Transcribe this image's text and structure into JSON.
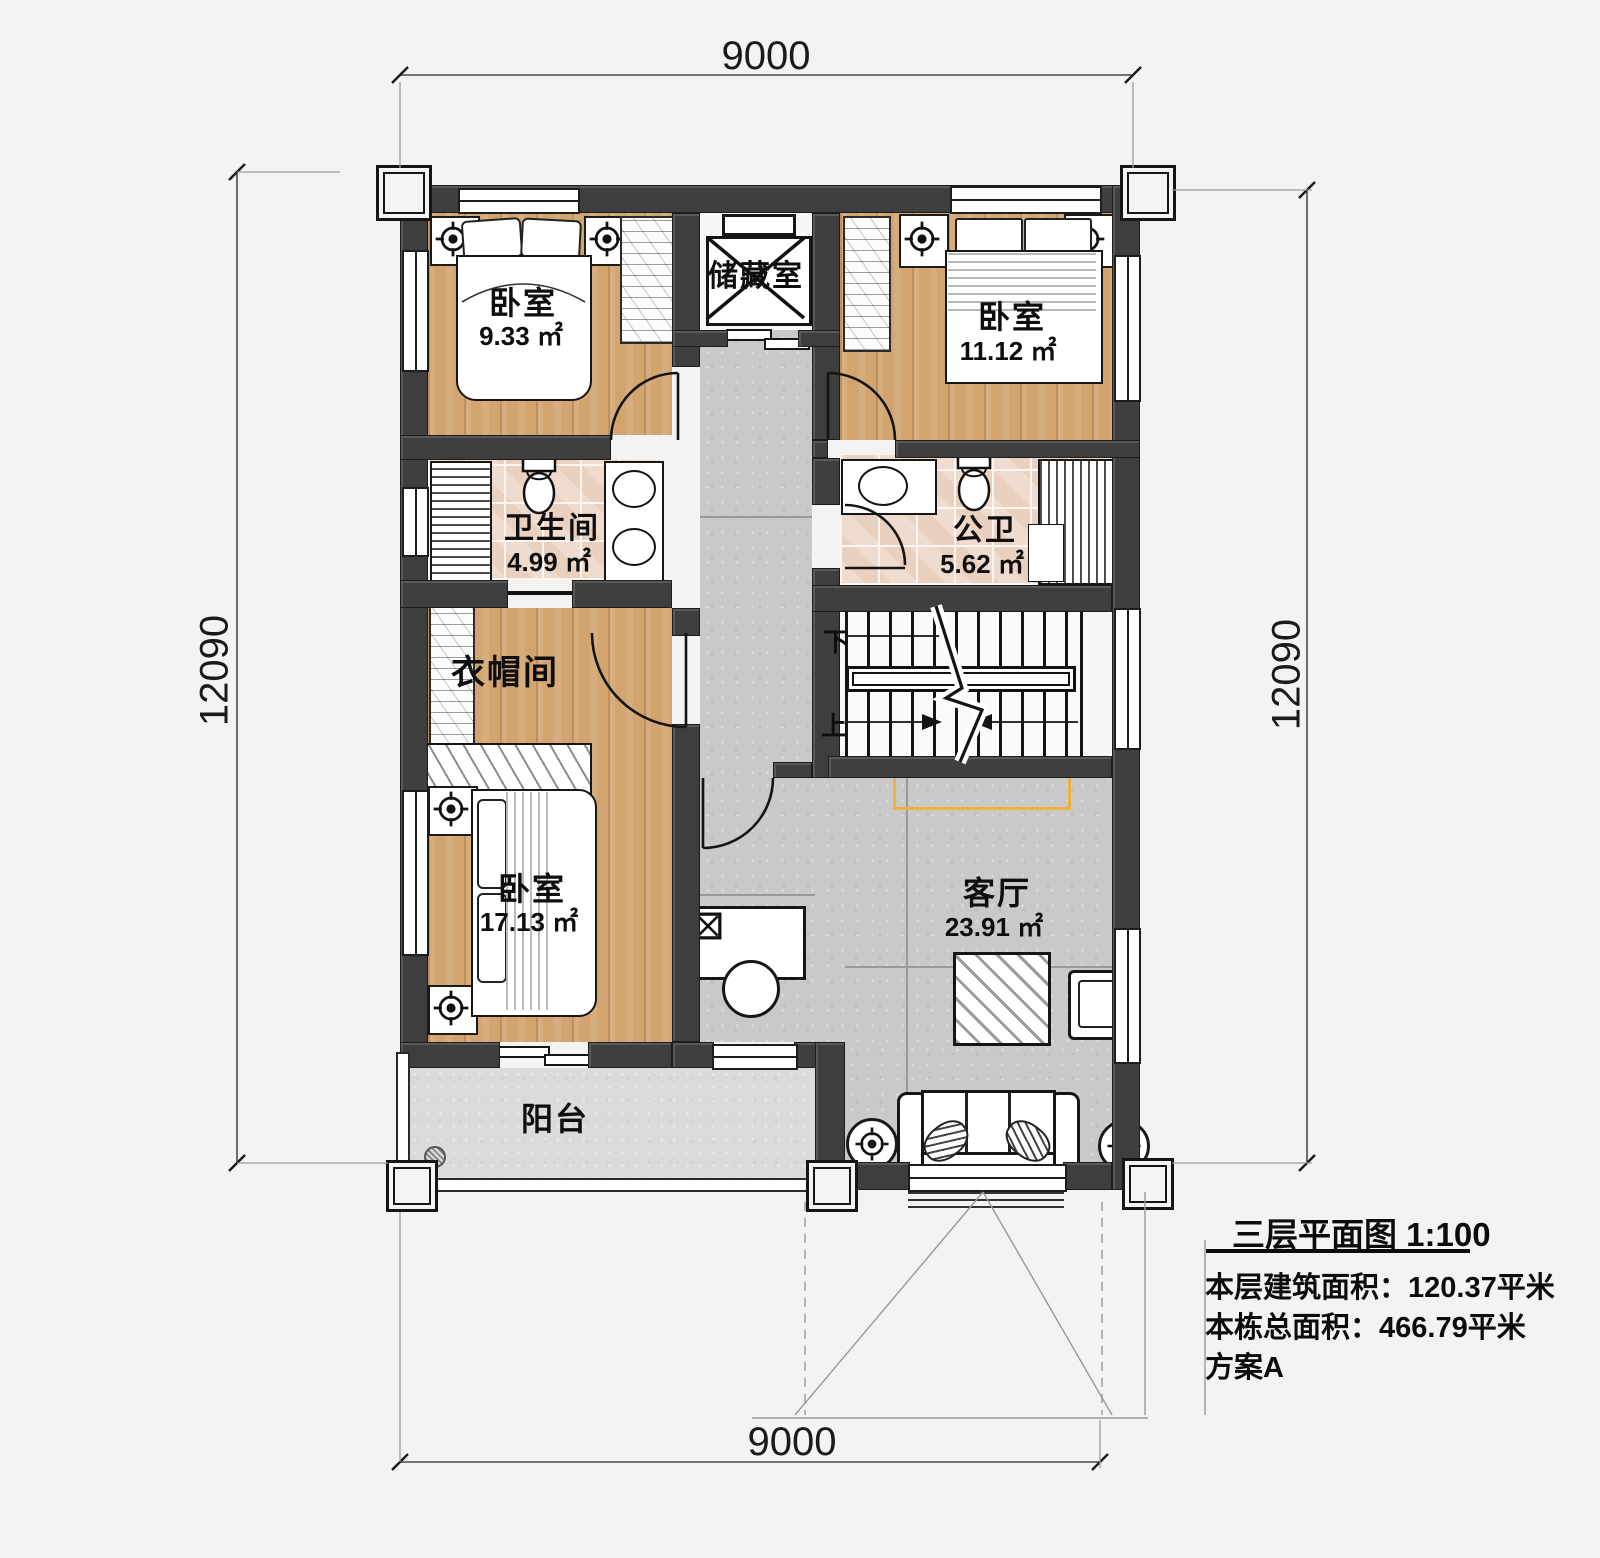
{
  "plan": {
    "dimensions": {
      "top": "9000",
      "bottom": "9000",
      "left": "12090",
      "right": "12090"
    },
    "rooms": {
      "bedroom_nw": {
        "label": "卧室",
        "area": "9.33 ㎡"
      },
      "storage": {
        "label": "储藏室"
      },
      "bedroom_ne": {
        "label": "卧室",
        "area": "11.12 ㎡"
      },
      "bath_master": {
        "label": "卫生间",
        "area": "4.99 ㎡"
      },
      "bath_public": {
        "label": "公卫",
        "area": "5.62 ㎡"
      },
      "cloakroom": {
        "label": "衣帽间"
      },
      "bedroom_sw": {
        "label": "卧室",
        "area": "17.13 ㎡"
      },
      "living": {
        "label": "客厅",
        "area": "23.91 ㎡"
      },
      "balcony": {
        "label": "阳台"
      }
    },
    "stairs": {
      "down_label": "下",
      "up_label": "上"
    }
  },
  "title_block": {
    "title": "三层平面图 1:100",
    "floor_area_line": "本层建筑面积：120.37平米",
    "total_area_line": "本栋总面积：466.79平米",
    "scheme_line": "方案A"
  },
  "colors": {
    "wall": "#3e3e3e",
    "wood_floor": "#d4a46e",
    "tile_floor": "#ead0be",
    "concrete_floor": "#c9c9c8",
    "balcony_floor": "#dbdbd9",
    "tv_highlight": "#efb23f"
  }
}
